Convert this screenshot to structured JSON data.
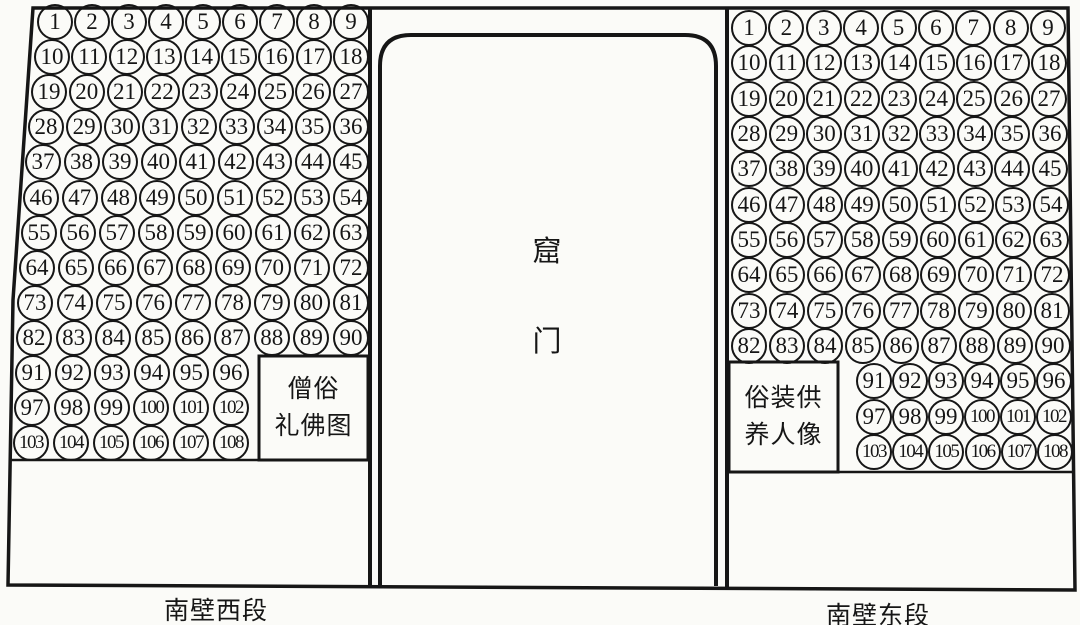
{
  "figure_title": "cave south wall statue numbering diagram",
  "door": {
    "label_top": "窟",
    "label_bottom": "门"
  },
  "west_wall": {
    "caption": "南壁西段",
    "inset_label_lines": [
      "僧俗",
      "礼佛图"
    ],
    "rows": [
      [
        1,
        2,
        3,
        4,
        5,
        6,
        7,
        8,
        9
      ],
      [
        10,
        11,
        12,
        13,
        14,
        15,
        16,
        17,
        18
      ],
      [
        19,
        20,
        21,
        22,
        23,
        24,
        25,
        26,
        27
      ],
      [
        28,
        29,
        30,
        31,
        32,
        33,
        34,
        35,
        36
      ],
      [
        37,
        38,
        39,
        40,
        41,
        42,
        43,
        44,
        45
      ],
      [
        46,
        47,
        48,
        49,
        50,
        51,
        52,
        53,
        54
      ],
      [
        55,
        56,
        57,
        58,
        59,
        60,
        61,
        62,
        63
      ],
      [
        64,
        65,
        66,
        67,
        68,
        69,
        70,
        71,
        72
      ],
      [
        73,
        74,
        75,
        76,
        77,
        78,
        79,
        80,
        81
      ],
      [
        82,
        83,
        84,
        85,
        86,
        87,
        88,
        89,
        90
      ],
      [
        91,
        92,
        93,
        94,
        95,
        96
      ],
      [
        97,
        98,
        99,
        100,
        101,
        102
      ],
      [
        103,
        104,
        105,
        106,
        107,
        108
      ]
    ]
  },
  "east_wall": {
    "caption": "南壁东段",
    "inset_label_lines": [
      "俗装供",
      "养人像"
    ],
    "rows": [
      [
        1,
        2,
        3,
        4,
        5,
        6,
        7,
        8,
        9
      ],
      [
        10,
        11,
        12,
        13,
        14,
        15,
        16,
        17,
        18
      ],
      [
        19,
        20,
        21,
        22,
        23,
        24,
        25,
        26,
        27
      ],
      [
        28,
        29,
        30,
        31,
        32,
        33,
        34,
        35,
        36
      ],
      [
        37,
        38,
        39,
        40,
        41,
        42,
        43,
        44,
        45
      ],
      [
        46,
        47,
        48,
        49,
        50,
        51,
        52,
        53,
        54
      ],
      [
        55,
        56,
        57,
        58,
        59,
        60,
        61,
        62,
        63
      ],
      [
        64,
        65,
        66,
        67,
        68,
        69,
        70,
        71,
        72
      ],
      [
        73,
        74,
        75,
        76,
        77,
        78,
        79,
        80,
        81
      ],
      [
        82,
        83,
        84,
        85,
        86,
        87,
        88,
        89,
        90
      ],
      [
        91,
        92,
        93,
        94,
        95,
        96
      ],
      [
        97,
        98,
        99,
        100,
        101,
        102
      ],
      [
        103,
        104,
        105,
        106,
        107,
        108
      ]
    ]
  },
  "colors": {
    "ink": "#161616",
    "paper": "#fbfbf8"
  }
}
